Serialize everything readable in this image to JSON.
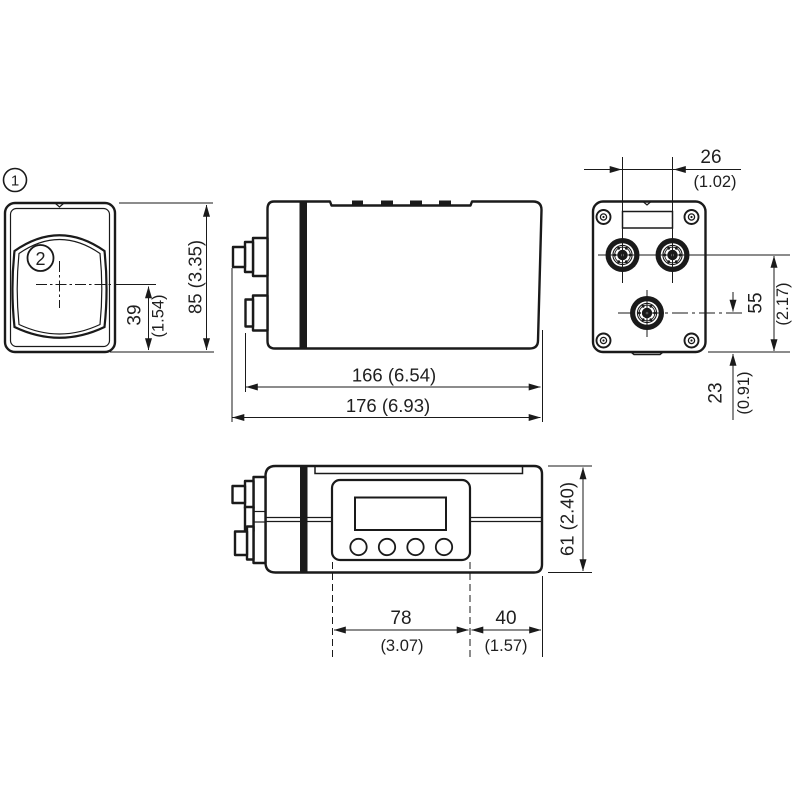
{
  "drawing": {
    "callout_1": "1",
    "callout_2": "2",
    "front_view": {
      "height": "85 (3.35)",
      "lens_offset_mm": "39",
      "lens_offset_in": "(1.54)"
    },
    "side_view": {
      "body_length": "166 (6.54)",
      "total_length": "176 (6.93)"
    },
    "rear_view": {
      "connector_spacing_mm": "26",
      "connector_spacing_in": "(1.02)",
      "connector_height_mm": "55",
      "connector_height_in": "(2.17)",
      "lower_connector_height_mm": "23",
      "lower_connector_height_in": "(0.91)"
    },
    "top_view": {
      "depth": "61 (2.40)",
      "display_width_mm": "78",
      "display_width_in": "(3.07)",
      "rear_section_mm": "40",
      "rear_section_in": "(1.57)"
    }
  }
}
